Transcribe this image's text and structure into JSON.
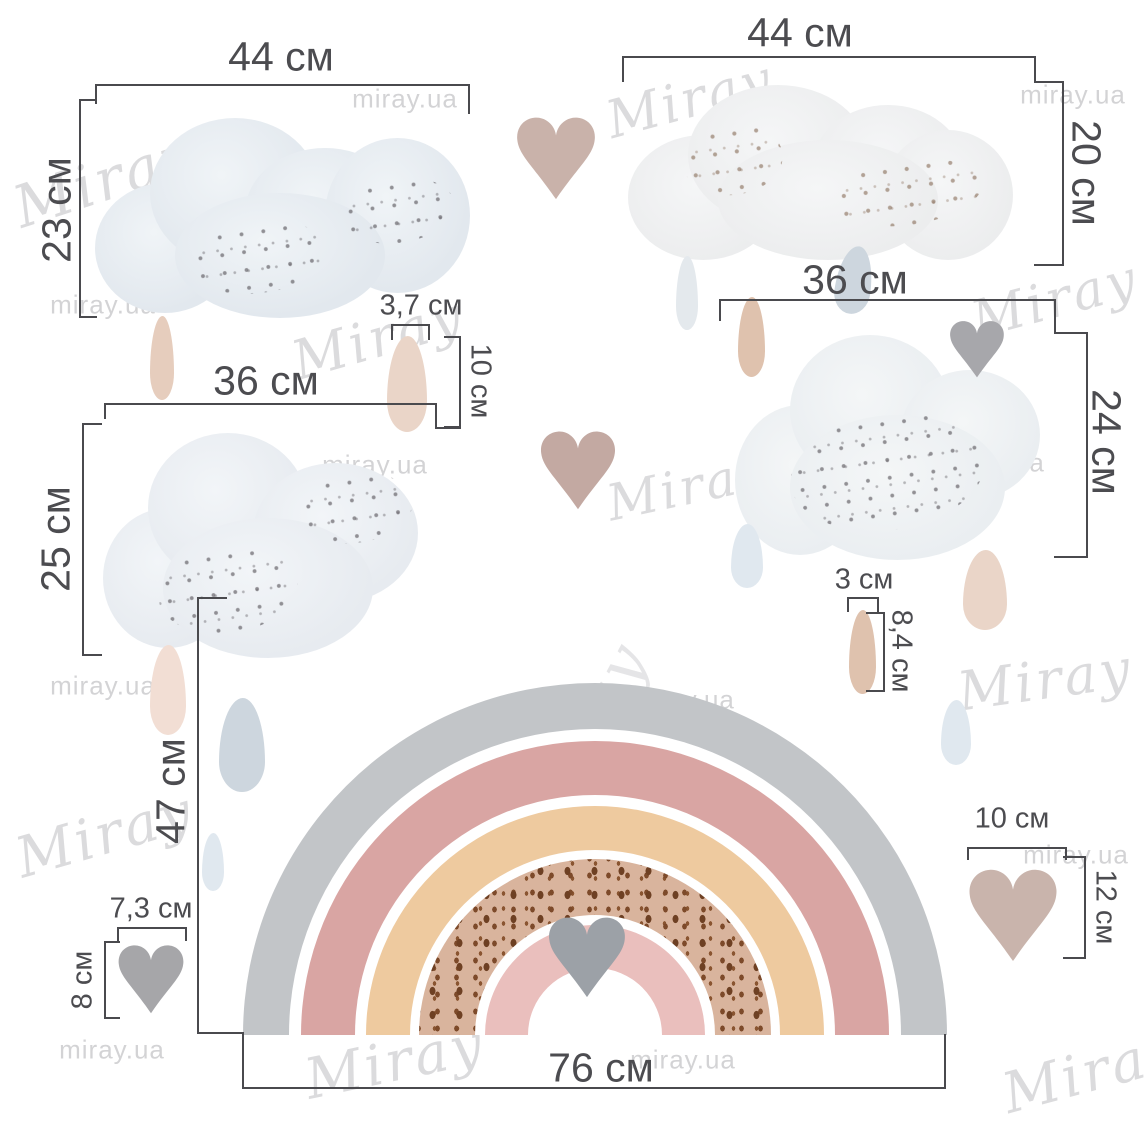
{
  "watermark": {
    "brand_script": "Miray",
    "brand_url": "miray.ua"
  },
  "stickers": {
    "cloud_top_left": {
      "width": "44 см",
      "height": "23 см"
    },
    "cloud_top_right": {
      "width": "44 см",
      "height": "20 см"
    },
    "raindrop_measured_left": {
      "width": "3,7 см",
      "height": "10 см"
    },
    "cloud_middle_left": {
      "width": "36 см",
      "height": "25 см"
    },
    "cloud_middle_right": {
      "width": "36 см",
      "height": "24 см"
    },
    "raindrop_measured_right": {
      "width": "3 см",
      "height": "8,4 см"
    },
    "rainbow": {
      "width": "76 см",
      "height": "47 см"
    },
    "heart_bottom_left": {
      "width": "7,3 см",
      "height": "8 см"
    },
    "heart_right": {
      "width": "10 см",
      "height": "12 см"
    }
  },
  "colors": {
    "dimension_ink": "#4a4a4e",
    "rainbow_gray": "#c2c5c8",
    "rainbow_rose": "#d9a5a3",
    "rainbow_peach": "#eeca9f",
    "rainbow_dotted_tan": "#d9b49d",
    "rainbow_dot_brown": "#6e4023",
    "rainbow_inner_pink": "#eabfbd",
    "heart_taupe": "#c9b2aa",
    "heart_gray": "#a7a7ab",
    "cloud_gray_blue": "#e2e8ee"
  }
}
